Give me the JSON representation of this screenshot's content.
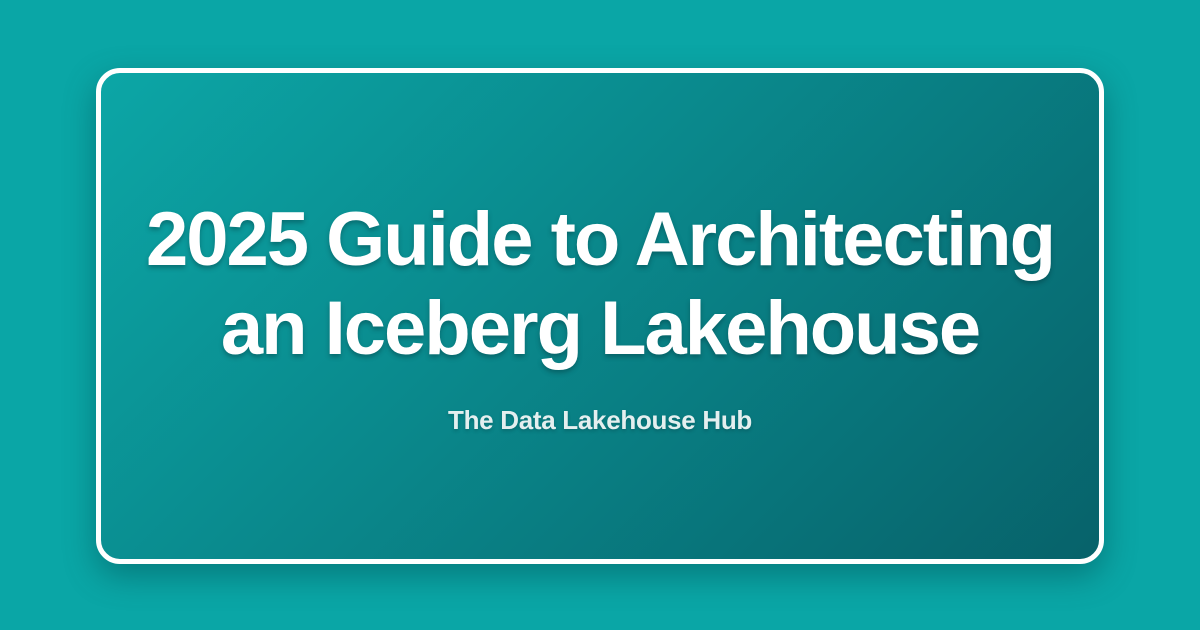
{
  "theme": {
    "background_color": "#0AA6A6",
    "card_border_color": "#FFFFFF",
    "card_gradient_start": "#0CA6A6",
    "card_gradient_end": "#07626A",
    "title_color": "#FFFFFF",
    "subtitle_color": "#E4EFEF"
  },
  "card": {
    "title_line1": "2025 Guide to Architecting",
    "title_line2": "an Iceberg Lakehouse",
    "subtitle": "The Data Lakehouse Hub"
  }
}
